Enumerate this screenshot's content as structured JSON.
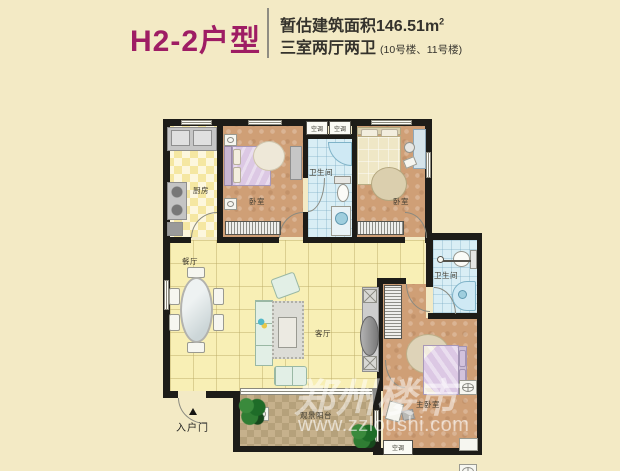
{
  "header": {
    "title": "H2-2户型",
    "area_text": "暂估建筑面积146.51m",
    "area_sup": "2",
    "spec_text": "三室两厅两卫",
    "spec_note": "(10号楼、11号楼)"
  },
  "labels": {
    "kitchen": "厨房",
    "bedroom_left": "卧室",
    "bathroom_top": "卫生间",
    "bedroom_right": "卧室",
    "dining": "餐厅",
    "living": "客厅",
    "bathroom_right": "卫生间",
    "master_bedroom": "主卧室",
    "balcony": "观景阳台",
    "entrance": "入户门",
    "ac": "空调"
  },
  "watermark": {
    "brand": "郑州楼市",
    "url": "www.zzloushi.com"
  },
  "colors": {
    "title": "#9e1d64",
    "background": "#f3eac5",
    "wall": "#1d1c18",
    "living_floor": "#f8efb5",
    "bedroom_floor": "#cf9f76",
    "bathroom_floor": "#d9eef5",
    "balcony_floor": "#c6b18c"
  }
}
